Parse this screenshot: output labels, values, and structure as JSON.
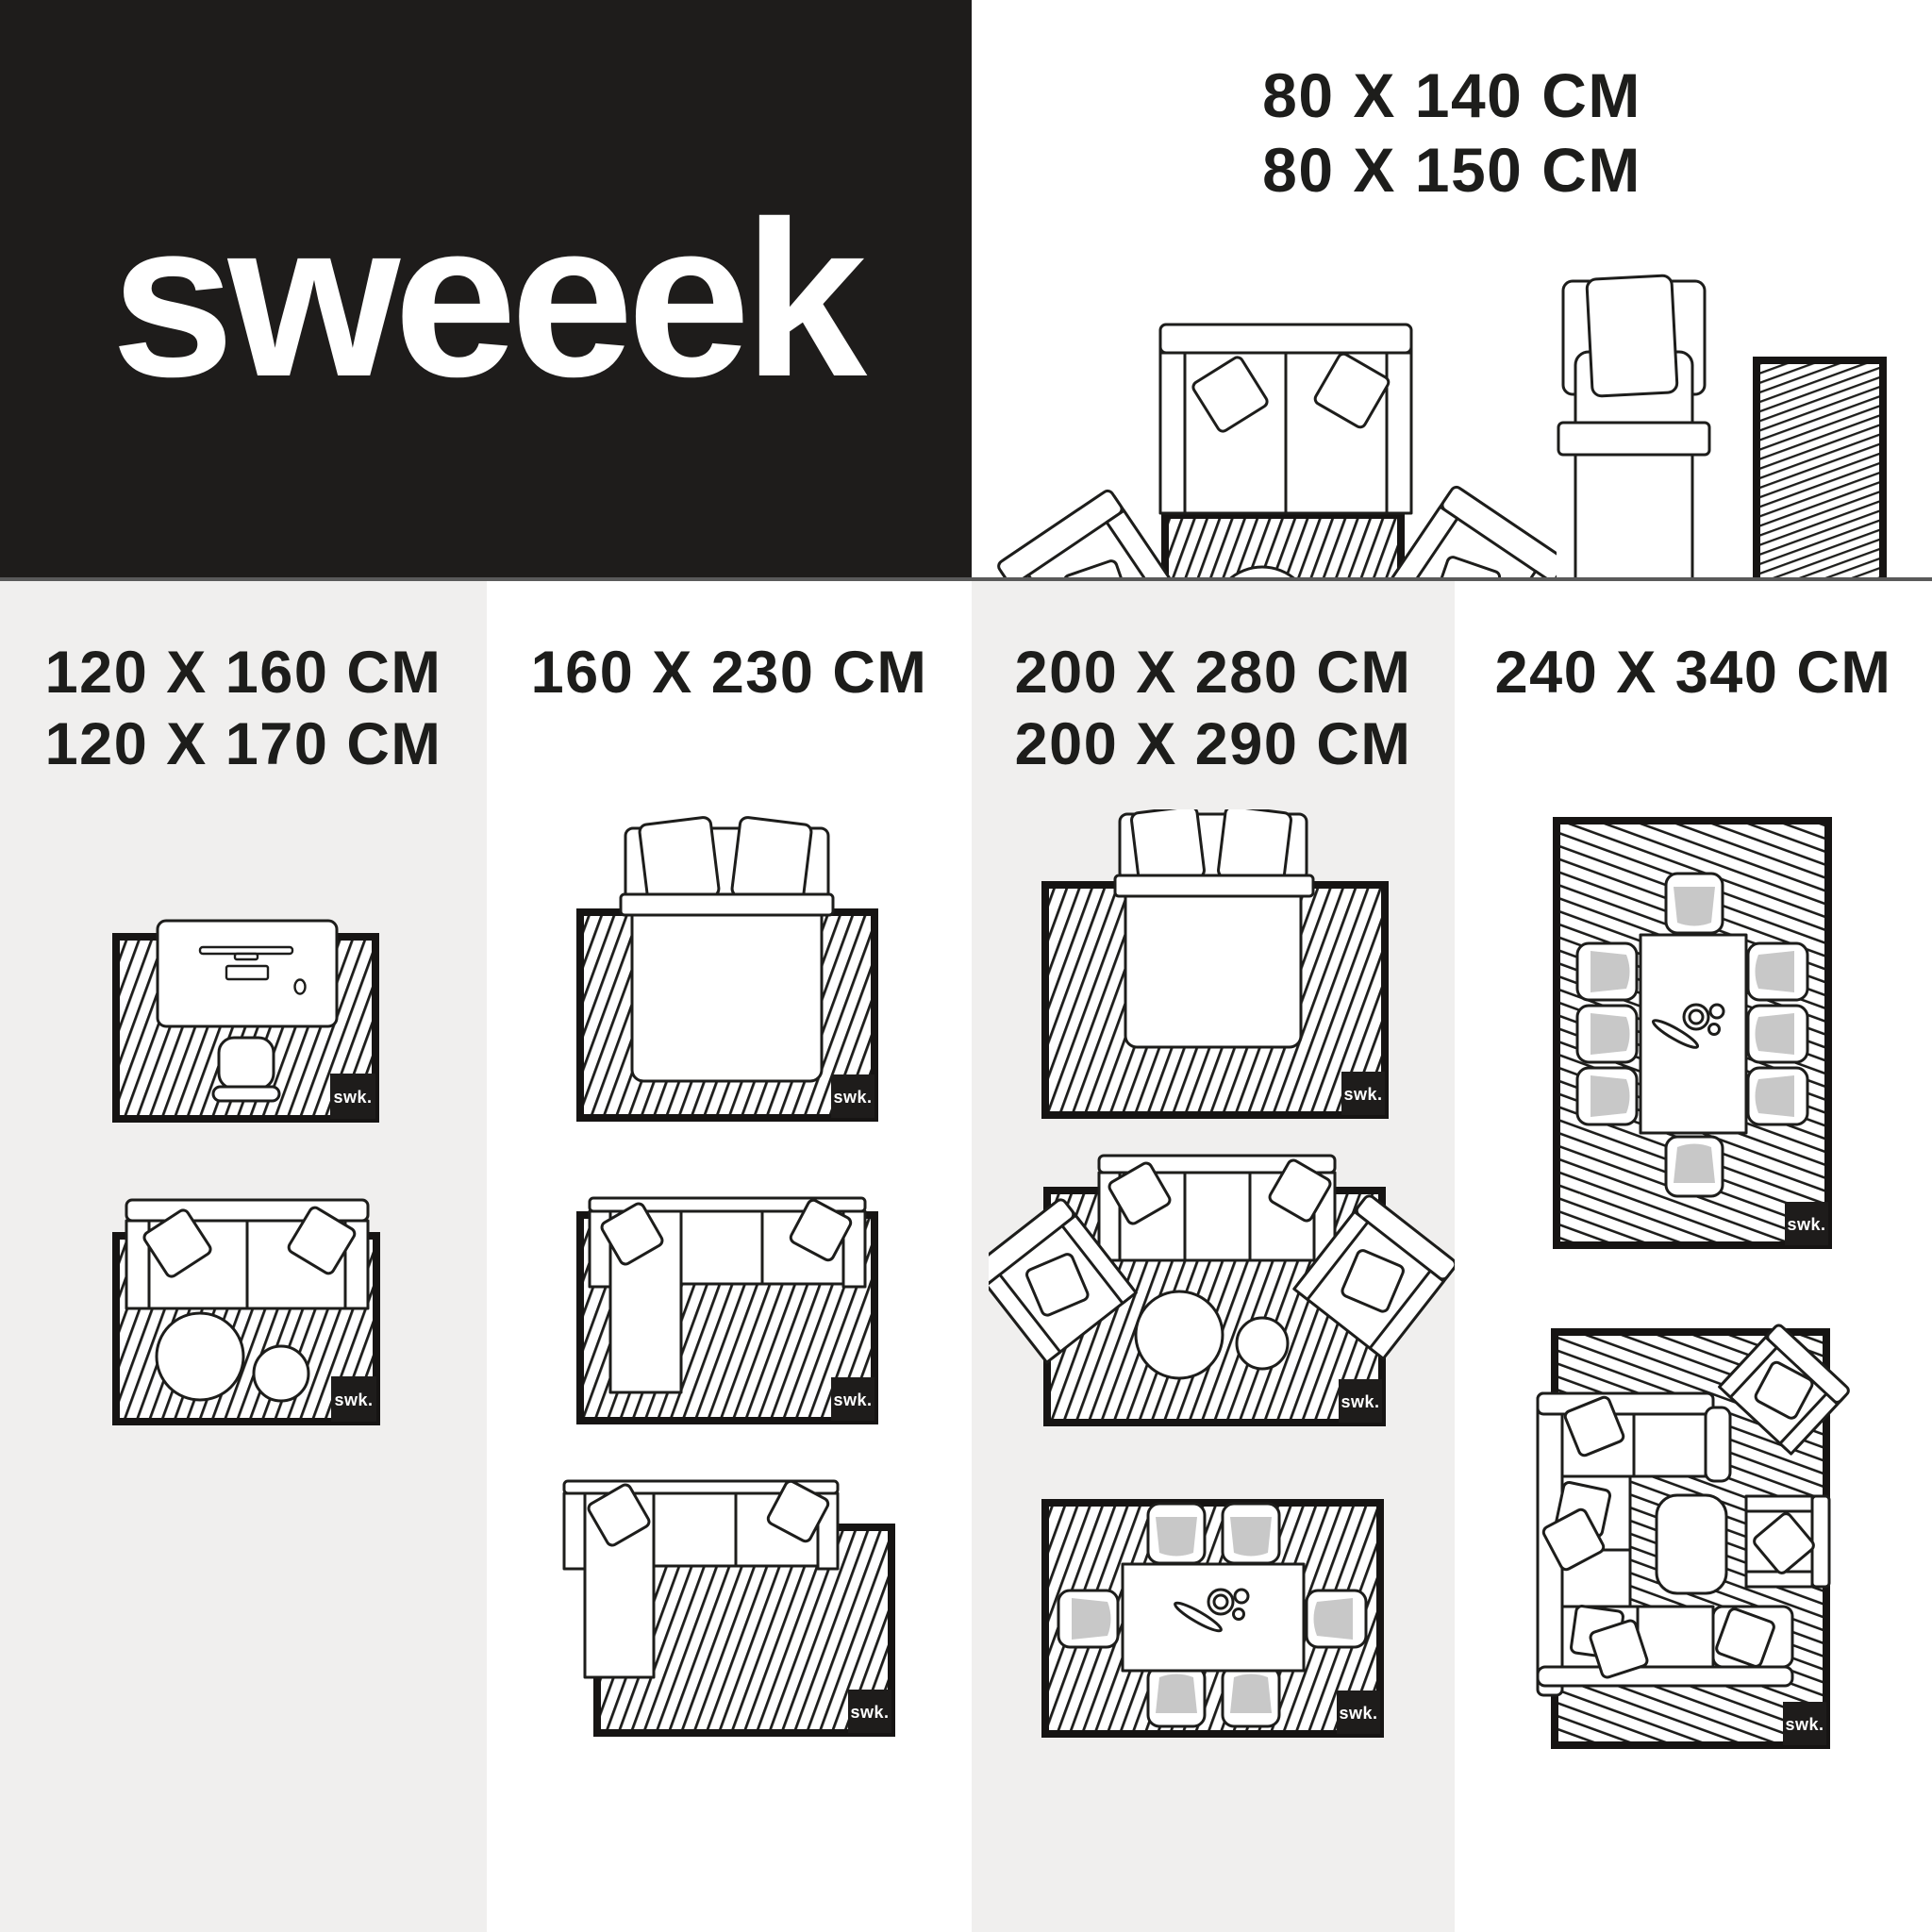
{
  "brand": {
    "logo": "sweeek",
    "watermark": "swk."
  },
  "colors": {
    "black_panel": "#1e1c1b",
    "gray_panel": "#f0efee",
    "divider": "#5a5a5a",
    "line": "#1d1d1b",
    "seat_gray": "#c8c8c8",
    "white": "#ffffff"
  },
  "sections": {
    "top_right": {
      "title_lines": [
        "80 X 140 CM",
        "80 X 150 CM"
      ],
      "scenes": [
        "sofa-two-armchairs-coffee-table-rug",
        "single-bed-with-runner-rug"
      ]
    },
    "columns": [
      {
        "title_lines": [
          "120 X 160 CM",
          "120 X 170 CM"
        ],
        "scenes": [
          "desk-workspace-on-rug",
          "two-seat-sofa-coffee-table-on-rug"
        ]
      },
      {
        "title_lines": [
          "160 X 230 CM"
        ],
        "scenes": [
          "double-bed-on-rug",
          "corner-sofa-on-rug",
          "corner-sofa-offset-rug"
        ]
      },
      {
        "title_lines": [
          "200 X 280 CM",
          "200 X 290 CM"
        ],
        "scenes": [
          "double-bed-on-large-rug",
          "sofa-two-armchairs-coffee-table-on-rug",
          "dining-table-six-chairs-on-rug"
        ]
      },
      {
        "title_lines": [
          "240 X 340 CM"
        ],
        "scenes": [
          "dining-table-eight-chairs-on-rug",
          "lounge-corner-sofa-set-on-rug"
        ]
      }
    ]
  }
}
